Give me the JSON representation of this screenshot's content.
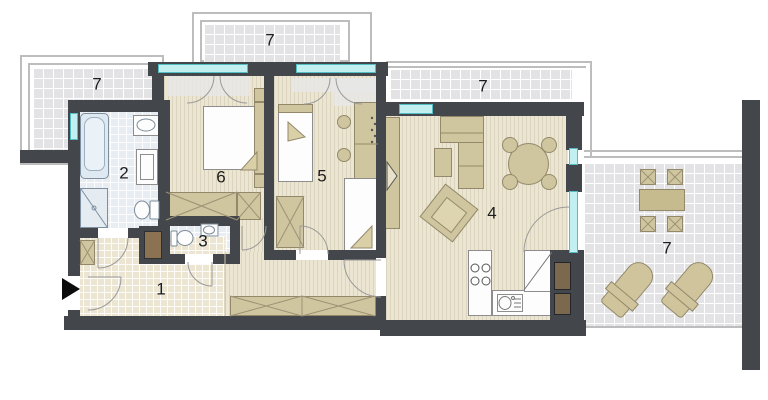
{
  "rooms": [
    {
      "key": "hall",
      "number": "1"
    },
    {
      "key": "bathroom",
      "number": "2"
    },
    {
      "key": "wc",
      "number": "3"
    },
    {
      "key": "living-room-kitchen",
      "number": "4"
    },
    {
      "key": "bedroom-small",
      "number": "5"
    },
    {
      "key": "bedroom-large",
      "number": "6"
    },
    {
      "key": "terrace-north-west",
      "number": "7"
    },
    {
      "key": "balcony-north",
      "number": "7"
    },
    {
      "key": "balcony-north-east",
      "number": "7"
    },
    {
      "key": "terrace-east",
      "number": "7"
    }
  ],
  "colors": {
    "wall": "#43474b",
    "window_glass": "#c2efef",
    "wood_floor": "#ebe5d1",
    "hall_tile": "#ece5d1",
    "bath_tile": "#e7edf3",
    "terrace_tile": "#e3e3e5",
    "furniture": "#cfc69f",
    "railing": "#bdbdbd",
    "shaft": "#8a7252",
    "entrance_arrow": "#0c0c0c"
  }
}
